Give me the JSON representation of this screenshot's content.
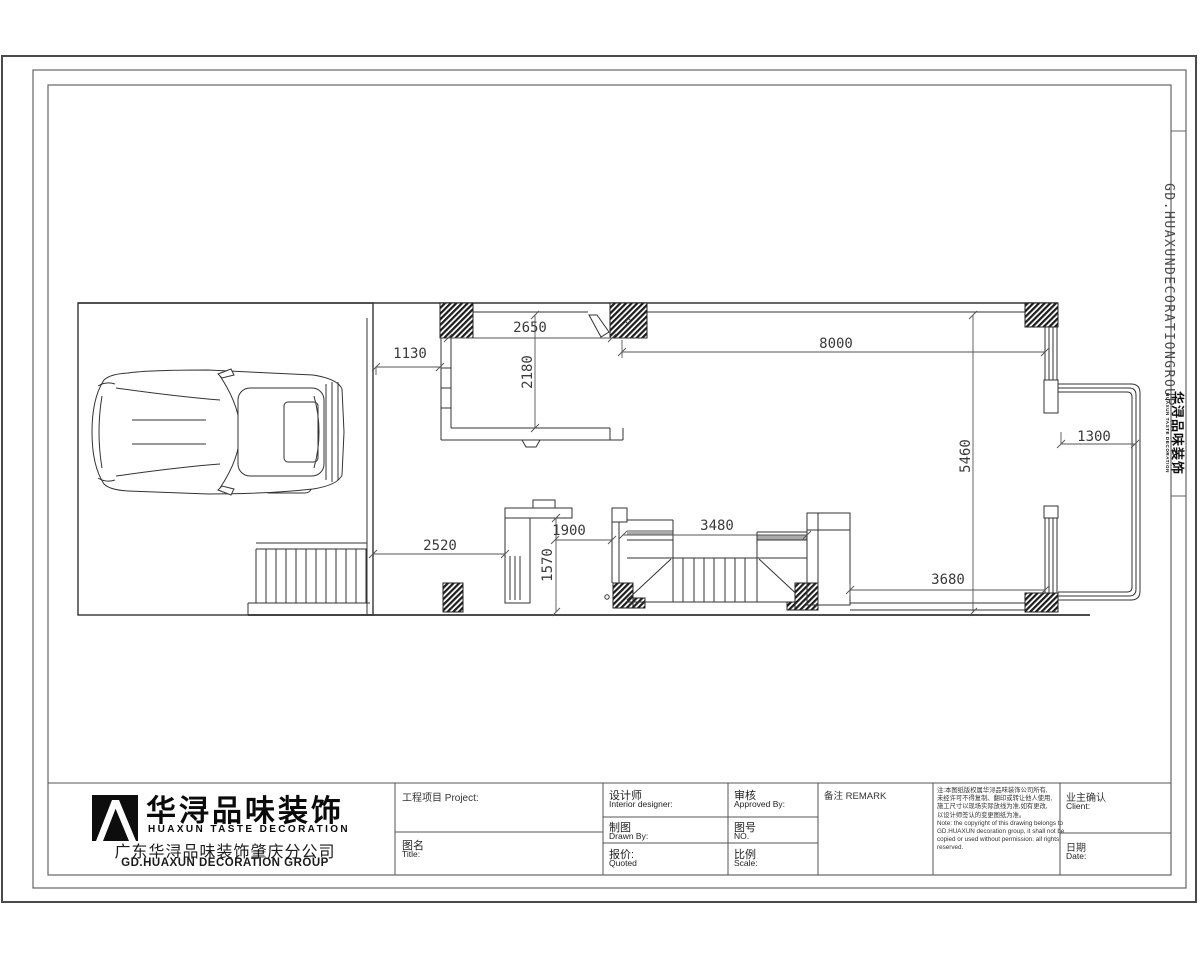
{
  "side_strip": {
    "vertical_text": "GD.HUAXUNDECORATIONGROUP",
    "logo_cn": "华浔品味装饰",
    "logo_en": "HUAXUN TASTE DECORATION"
  },
  "plan": {
    "dims": {
      "d2650": "2650",
      "d1130": "1130",
      "d2180": "2180",
      "d8000": "8000",
      "d5460": "5460",
      "d1300": "1300",
      "d2520": "2520",
      "d1900": "1900",
      "d1570": "1570",
      "d3480": "3480",
      "d3680": "3680"
    }
  },
  "titleblock": {
    "logo": {
      "cn": "华浔品味装饰",
      "en": "HUAXUN TASTE DECORATION",
      "branch_cn": "广东华浔品味装饰肇庆分公司",
      "branch_en": "GD.HUAXUN DECORATION GROUP"
    },
    "fields": {
      "project": "工程项目  Project:",
      "title_cn": "图名",
      "title_en": "Title:",
      "designer_cn": "设计师",
      "designer_en": "Interior designer:",
      "drawn_cn": "制图",
      "drawn_en": "Drawn By:",
      "quoted_cn": "报价:",
      "quoted_en": "Quoted",
      "approved_cn": "审核",
      "approved_en": "Approved By:",
      "no_cn": "图号",
      "no_en": "NO.",
      "scale_cn": "比例",
      "scale_en": "Scale:",
      "remark": "备注  REMARK",
      "client_cn": "业主确认",
      "client_en": "Client:",
      "date_cn": "日期",
      "date_en": "Date:"
    },
    "disclaimer": [
      "注:本图纸版权属华浔品味装饰公司所有,",
      "未经许可不得复制、翻印或转让他人使用,",
      "施工尺寸以现场实际放线为准,如有更改,",
      "以设计师签认的变更图纸为准。",
      "Note: the copyright of this drawing belongs to",
      "GD.HUAXUN decoration group, it shall not be",
      "copied or used without permission. all rights",
      "reserved."
    ]
  }
}
